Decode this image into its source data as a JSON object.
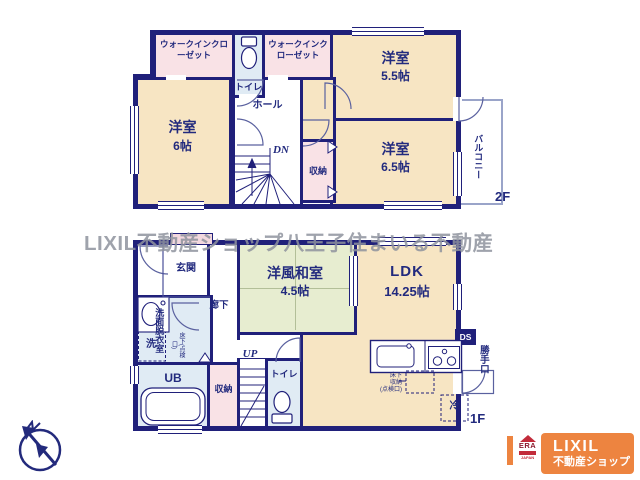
{
  "watermark": "LIXIL不動産ショップ八王子住まいる不動産",
  "floor2": {
    "label": "2F",
    "wic_left": "ウォークインクローゼット",
    "wic_right": "ウォークインクローゼット",
    "toilet": "トイレ",
    "bedroom_a": {
      "name": "洋室",
      "size": "5.5帖"
    },
    "bedroom_b": {
      "name": "洋室",
      "size": "6帖"
    },
    "bedroom_c": {
      "name": "洋室",
      "size": "6.5帖"
    },
    "hall": "ホール",
    "stairs_down": "DN",
    "closet": "収納",
    "balcony": "バルコニー"
  },
  "floor1": {
    "label": "1F",
    "entrance": "玄関",
    "corridor": "廊下",
    "japanese_room": {
      "name": "洋風和室",
      "size": "4.5帖"
    },
    "ldk": {
      "name": "LDK",
      "size": "14.25帖"
    },
    "washroom": "洗面脱衣室",
    "washroom_hatch": "床下(点検口)",
    "laundry": "洗",
    "bath": "UB",
    "closet": "収納",
    "stairs_up": "UP",
    "toilet": "トイレ",
    "duct": "DS",
    "back_door": "勝手口",
    "floor_storage": [
      "床下",
      "収納",
      "(点検口)"
    ],
    "fridge": "冷"
  },
  "branding": {
    "era": "ERA",
    "era_country": "JAPAN",
    "lixil": "LIXIL",
    "shop": "不動産ショップ"
  },
  "colors": {
    "wall": "#20207a",
    "room_cream": "#f7e5c3",
    "closet_pink": "#f9e2e6",
    "wet_blue": "#e0ebf4",
    "tatami_green": "#e7edd0",
    "brand_orange": "#ed8440",
    "era_red": "#c22b3a",
    "watermark_gray": "#8f939e"
  }
}
